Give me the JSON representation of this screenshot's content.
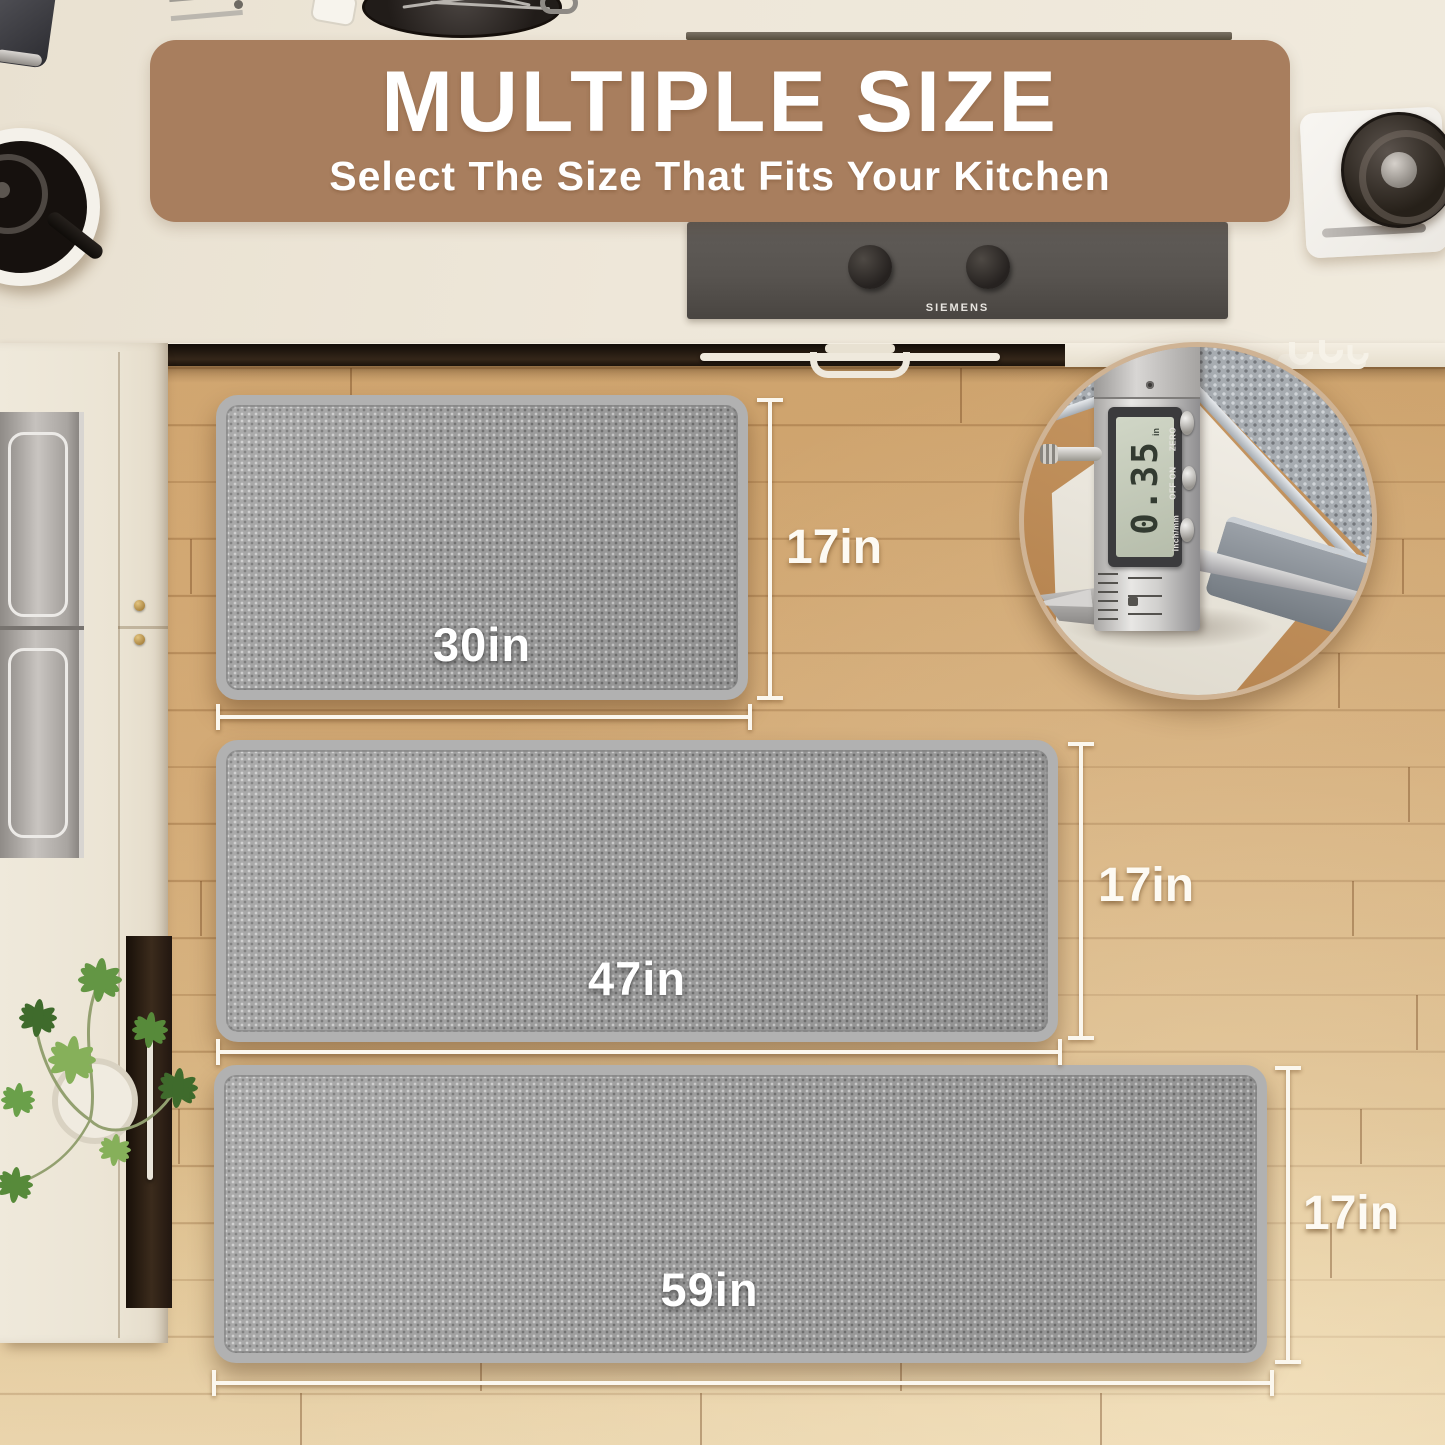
{
  "banner": {
    "title": "MULTIPLE SIZE",
    "subtitle": "Select The Size That Fits Your Kitchen"
  },
  "mats": [
    {
      "name": "small mat",
      "width_label": "30in",
      "height_label": "17in"
    },
    {
      "name": "medium runner",
      "width_label": "47in",
      "height_label": "17in"
    },
    {
      "name": "large runner",
      "width_label": "59in",
      "height_label": "17in"
    }
  ],
  "cooktop": {
    "brand": "SIEMENS"
  },
  "caliper_inset": {
    "reading": "0.35",
    "unit": "in",
    "button_labels": [
      "ZERO",
      "ON",
      "OFF"
    ],
    "mode_label": "inch/mm"
  },
  "colors": {
    "banner_bg": "#a87e5e",
    "text": "#ffffff",
    "mat_surface": "#9b9b9b",
    "mat_binding": "#b1b1b1",
    "floor_wood": "#d2a46a",
    "countertop": "#ece5d6",
    "cooktop_panel": "#56524e",
    "inset_ring": "#cfb394"
  }
}
